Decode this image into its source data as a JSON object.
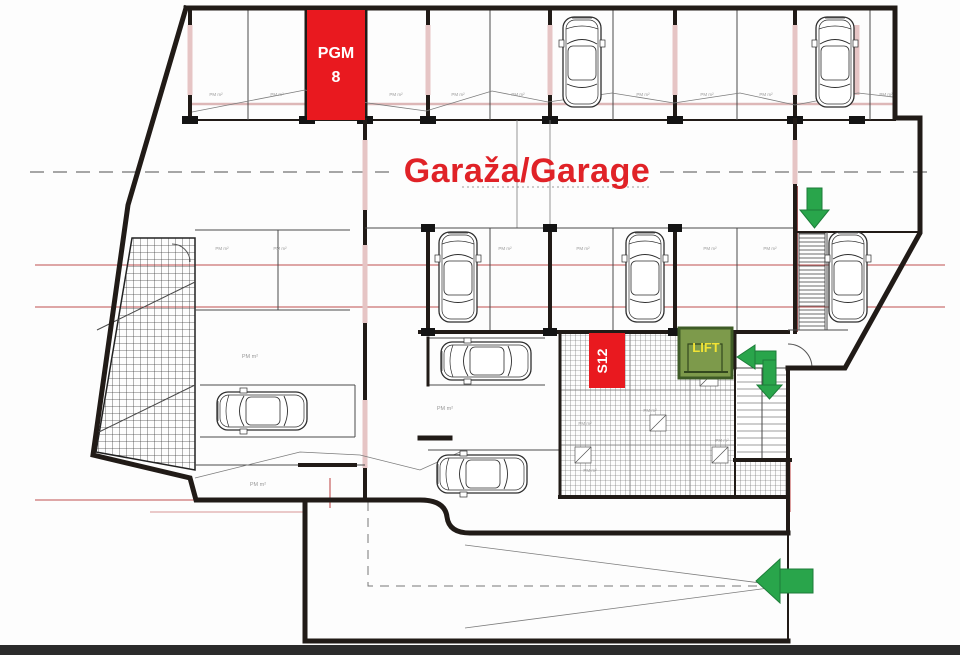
{
  "plan": {
    "title": "Garaža/Garage",
    "pgm_box": {
      "line1": "PGM",
      "line2": "8"
    },
    "s12_label": "S12",
    "lift_label": "LIFT",
    "stall_label": "PM m²"
  },
  "colors": {
    "accent_red": "#e9191f",
    "title_red": "#e02227",
    "arrow_green": "#29a54b",
    "lift_fill": "#7d9a4b",
    "lift_border": "#3e5b26",
    "lift_text": "#f1e335",
    "wall_black": "#211b17",
    "dim_red": "#c05050",
    "bottom_bar": "#2b2b2b"
  }
}
